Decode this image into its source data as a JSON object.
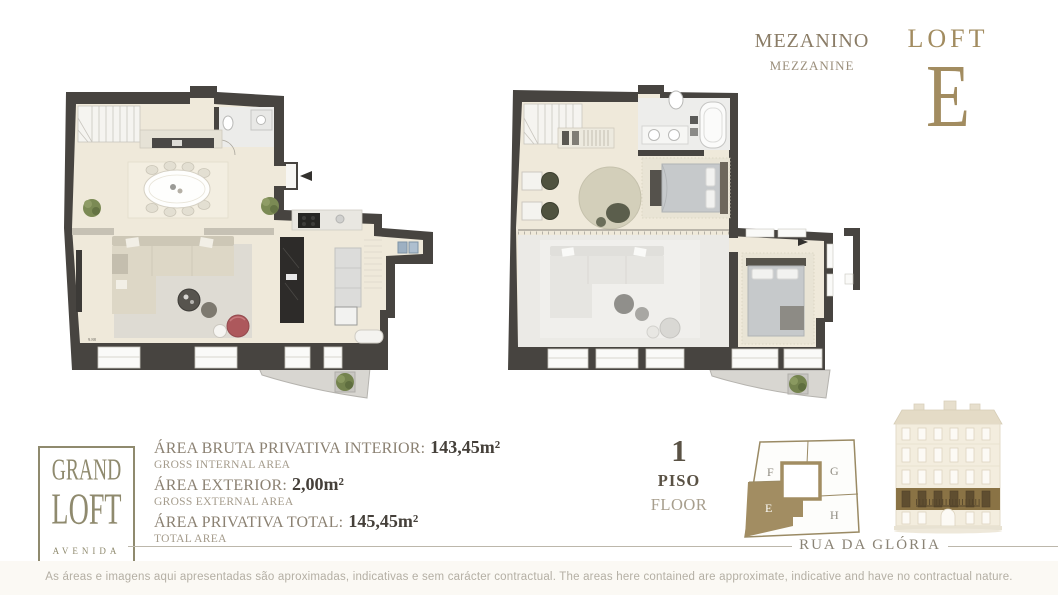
{
  "plan_labels": {
    "mezzanine_pt": "MEZANINO",
    "mezzanine_en": "MEZZANINE"
  },
  "loft": {
    "word": "LOFT",
    "unit": "E"
  },
  "logo": {
    "line1": "GRAND",
    "line2": "LOFT",
    "line3": "AVENIDA"
  },
  "areas": {
    "rows": [
      {
        "label_pt": "ÁREA BRUTA PRIVATIVA INTERIOR:",
        "value": "143,45m²",
        "label_en": "GROSS INTERNAL AREA"
      },
      {
        "label_pt": "ÁREA EXTERIOR:",
        "value": "2,00m²",
        "label_en": "GROSS EXTERNAL AREA"
      },
      {
        "label_pt": "ÁREA PRIVATIVA TOTAL:",
        "value": "145,45m²",
        "label_en": "TOTAL AREA"
      }
    ]
  },
  "floor_indicator": {
    "number": "1",
    "label_pt": "PISO",
    "label_en": "FLOOR"
  },
  "key_plan": {
    "units": {
      "f": "F",
      "g": "G",
      "e": "E",
      "h": "H"
    },
    "highlighted_unit": "E"
  },
  "street": {
    "name": "RUA DA GLÓRIA"
  },
  "plan_annotations": {
    "left_width_dim": "9.88"
  },
  "disclaimer": {
    "text": "As áreas e imagens aqui apresentadas são aproximadas, indicativas e sem carácter contractual. The areas here contained are approximate, indicative and have no contractual nature."
  },
  "colors": {
    "accent_gold": "#A28C60",
    "keyplan_gold": "#9A8A64",
    "wall": "#474440",
    "floor_beige": "#EFE9DA",
    "highlight_floor_band": "#8A7345",
    "text_brown": "#8B8172",
    "text_dark": "#45403A",
    "text_light": "#A49B8B",
    "disclaimer_gray": "#B4AFA4",
    "red_armchair": "#AD585C"
  }
}
